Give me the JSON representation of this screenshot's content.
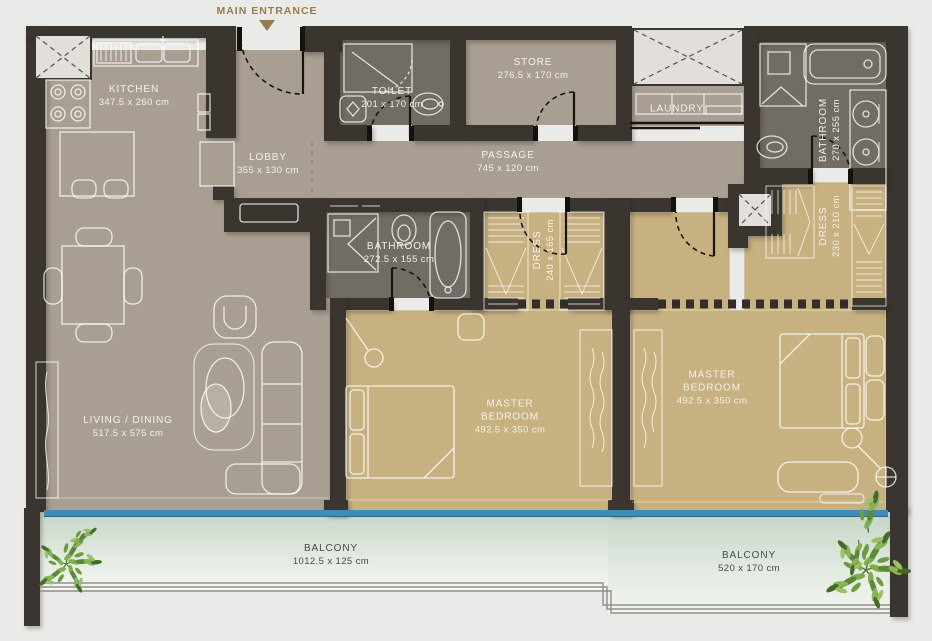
{
  "plan": {
    "entrance_label": "MAIN ENTRANCE",
    "rooms": {
      "kitchen": {
        "name": "KITCHEN",
        "dims": "347.5 x 260 cm"
      },
      "lobby": {
        "name": "LOBBY",
        "dims": "355 x 130 cm"
      },
      "toilet": {
        "name": "TOILET",
        "dims": "201 x 170 cm"
      },
      "store": {
        "name": "STORE",
        "dims": "276.5 x 170 cm"
      },
      "laundry": {
        "name": "LAUNDRY",
        "dims": ""
      },
      "bathroom_top": {
        "name": "BATHROOM",
        "dims": "270 x 255 cm"
      },
      "passage": {
        "name": "PASSAGE",
        "dims": "745 x 120 cm"
      },
      "bathroom_mid": {
        "name": "BATHROOM",
        "dims": "272.5 x 155 cm"
      },
      "dress_mid": {
        "name": "DRESS",
        "dims": "240 x 165 cm"
      },
      "dress_right": {
        "name": "DRESS",
        "dims": "230 x 210 cm"
      },
      "master_bedroom_1": {
        "name": "MASTER BEDROOM",
        "dims": "492.5 x 350 cm"
      },
      "master_bedroom_2": {
        "name": "MASTER BEDROOM",
        "dims": "492.5 x 350 cm"
      },
      "living_dining": {
        "name": "LIVING / DINING",
        "dims": "517.5 x 575 cm"
      },
      "balcony_left": {
        "name": "BALCONY",
        "dims": "1012.5 x 125 cm"
      },
      "balcony_right": {
        "name": "BALCONY",
        "dims": "520 x 170 cm"
      }
    },
    "colors": {
      "page_bg": "#eaeae8",
      "wall": "#3a352e",
      "floor_main": "#a89f92",
      "floor_bath": "#716c64",
      "floor_gold": "#c7b181",
      "balcony_top": "#c8d7c9",
      "balcony_mid": "#e2eae1",
      "balcony_bottom": "#f4f6f1",
      "glass": "#3e8db9",
      "shaft": "#e2dfdb",
      "entrance": "#9a7a48",
      "label_light": "#f4f1ea",
      "label_dark": "#4c4a46"
    }
  }
}
